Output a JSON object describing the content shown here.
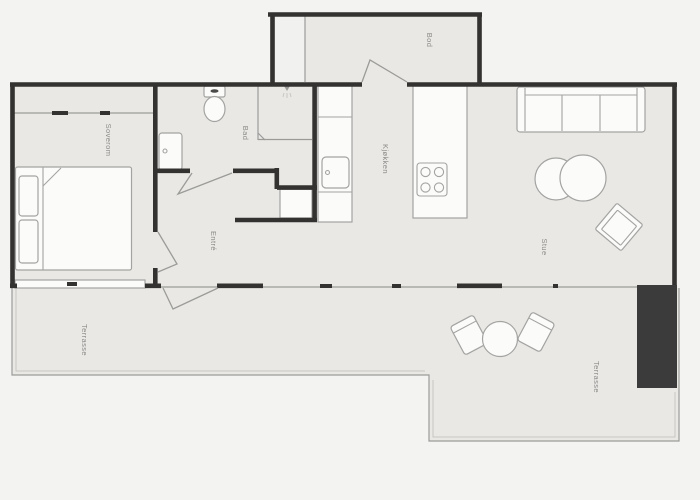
{
  "title": "Apartment floor plan",
  "colors": {
    "background": "#f3f3f1",
    "floor": "#e9e8e5",
    "floor_light": "#f1f1ef",
    "wall": "#333230",
    "solid_wall": "#3b3b3b",
    "furniture_fill": "#fbfbf9",
    "furniture_stroke": "#a3a3a1",
    "thin_line": "#9b9b99",
    "hair_line": "#c6c6c4",
    "label_text": "#8a8a88"
  },
  "rooms": {
    "soverom": "Soverom",
    "bad": "Bad",
    "bod": "Bod",
    "entre": "Entré",
    "kjokken": "Kjøkken",
    "stue": "Stue",
    "terrasse": "Terrasse"
  }
}
